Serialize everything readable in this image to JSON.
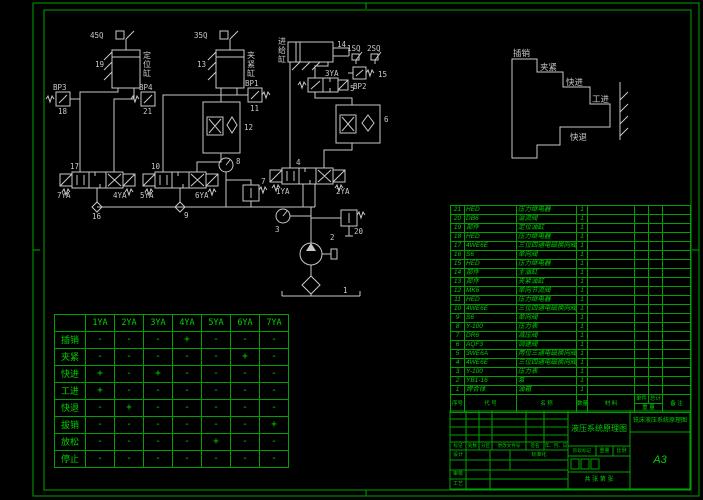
{
  "drawing": {
    "background": "#000000",
    "frame_color": "#00a400",
    "schematic_color": "#c8c8c8",
    "table_color": "#00d000"
  },
  "schematic": {
    "labels": [
      {
        "text": "45Q",
        "x": 90,
        "y": 38
      },
      {
        "text": "35Q",
        "x": 194,
        "y": 38
      },
      {
        "text": "19",
        "x": 95,
        "y": 67
      },
      {
        "text": "13",
        "x": 197,
        "y": 67
      },
      {
        "text": "定位缸",
        "x": 143,
        "y": 58,
        "vertical": true
      },
      {
        "text": "夹紧缸",
        "x": 247,
        "y": 58,
        "vertical": true
      },
      {
        "text": "进给缸",
        "x": 278,
        "y": 44,
        "vertical": true
      },
      {
        "text": "14",
        "x": 337,
        "y": 47
      },
      {
        "text": "BP3",
        "x": 53,
        "y": 90
      },
      {
        "text": "18",
        "x": 58,
        "y": 114
      },
      {
        "text": "BP4",
        "x": 139,
        "y": 90
      },
      {
        "text": "21",
        "x": 143,
        "y": 114
      },
      {
        "text": "BP1",
        "x": 245,
        "y": 86
      },
      {
        "text": "11",
        "x": 250,
        "y": 111
      },
      {
        "text": "12",
        "x": 244,
        "y": 130
      },
      {
        "text": "1SQ",
        "x": 347,
        "y": 51
      },
      {
        "text": "2SQ",
        "x": 367,
        "y": 51
      },
      {
        "text": "15",
        "x": 378,
        "y": 77
      },
      {
        "text": "BP2",
        "x": 353,
        "y": 89
      },
      {
        "text": "3YA",
        "x": 325,
        "y": 76
      },
      {
        "text": "5",
        "x": 350,
        "y": 91
      },
      {
        "text": "6",
        "x": 384,
        "y": 122
      },
      {
        "text": "17",
        "x": 70,
        "y": 169
      },
      {
        "text": "10",
        "x": 151,
        "y": 169
      },
      {
        "text": "4",
        "x": 296,
        "y": 165
      },
      {
        "text": "7YA",
        "x": 57,
        "y": 198
      },
      {
        "text": "4YA",
        "x": 113,
        "y": 198
      },
      {
        "text": "5YA",
        "x": 140,
        "y": 198
      },
      {
        "text": "6YA",
        "x": 195,
        "y": 198
      },
      {
        "text": "1YA",
        "x": 276,
        "y": 194
      },
      {
        "text": "2YA",
        "x": 336,
        "y": 194
      },
      {
        "text": "16",
        "x": 92,
        "y": 219
      },
      {
        "text": "9",
        "x": 184,
        "y": 218
      },
      {
        "text": "8",
        "x": 236,
        "y": 164
      },
      {
        "text": "7",
        "x": 261,
        "y": 184
      },
      {
        "text": "3",
        "x": 275,
        "y": 232
      },
      {
        "text": "2",
        "x": 330,
        "y": 240
      },
      {
        "text": "20",
        "x": 354,
        "y": 234
      },
      {
        "text": "1",
        "x": 343,
        "y": 293
      }
    ]
  },
  "cycle_diagram": {
    "steps": [
      "插销",
      "夹紧",
      "快进",
      "工进",
      "快退"
    ],
    "labels": [
      {
        "text": "插销",
        "x": 513,
        "y": 56
      },
      {
        "text": "夹紧",
        "x": 540,
        "y": 70
      },
      {
        "text": "快进",
        "x": 566,
        "y": 85
      },
      {
        "text": "工进",
        "x": 592,
        "y": 102
      },
      {
        "text": "快退",
        "x": 570,
        "y": 140
      }
    ]
  },
  "solenoid_table": {
    "columns": [
      "",
      "1YA",
      "2YA",
      "3YA",
      "4YA",
      "5YA",
      "6YA",
      "7YA"
    ],
    "rows": [
      {
        "name": "插销",
        "values": [
          "-",
          "-",
          "-",
          "+",
          "-",
          "-",
          "-"
        ]
      },
      {
        "name": "夹紧",
        "values": [
          "-",
          "-",
          "-",
          "-",
          "-",
          "+",
          "-"
        ]
      },
      {
        "name": "快进",
        "values": [
          "+",
          "-",
          "+",
          "-",
          "-",
          "-",
          "-"
        ]
      },
      {
        "name": "工进",
        "values": [
          "+",
          "-",
          "-",
          "-",
          "-",
          "-",
          "-"
        ]
      },
      {
        "name": "快退",
        "values": [
          "-",
          "+",
          "-",
          "-",
          "-",
          "-",
          "-"
        ]
      },
      {
        "name": "拔销",
        "values": [
          "-",
          "-",
          "-",
          "-",
          "-",
          "-",
          "+"
        ]
      },
      {
        "name": "放松",
        "values": [
          "-",
          "-",
          "-",
          "-",
          "+",
          "-",
          "-"
        ]
      },
      {
        "name": "停止",
        "values": [
          "-",
          "-",
          "-",
          "-",
          "-",
          "-",
          "-"
        ]
      }
    ]
  },
  "parts_list": {
    "footer": {
      "no": "序号",
      "code": "代 号",
      "name": "名  称",
      "qty": "数量",
      "material": "材 料",
      "unit": "单件",
      "total": "总计",
      "weight": "重 量",
      "remark": "备 注"
    },
    "rows": [
      {
        "no": "21",
        "code": "HED",
        "name": "压力继电器",
        "qty": "1"
      },
      {
        "no": "20",
        "code": "DB6",
        "name": "溢流阀",
        "qty": "1"
      },
      {
        "no": "19",
        "code": "部件",
        "name": "定位油缸",
        "qty": "1"
      },
      {
        "no": "18",
        "code": "HED",
        "name": "压力继电器",
        "qty": "1"
      },
      {
        "no": "17",
        "code": "4WE6E",
        "name": "三位四通电磁换向阀",
        "qty": "1"
      },
      {
        "no": "16",
        "code": "S6",
        "name": "单向阀",
        "qty": "1"
      },
      {
        "no": "15",
        "code": "HED",
        "name": "压力继电器",
        "qty": "1"
      },
      {
        "no": "14",
        "code": "部件",
        "name": "主油缸",
        "qty": "1"
      },
      {
        "no": "13",
        "code": "部件",
        "name": "夹紧油缸",
        "qty": "1"
      },
      {
        "no": "12",
        "code": "MK6",
        "name": "单向节流阀",
        "qty": "1"
      },
      {
        "no": "11",
        "code": "HED",
        "name": "压力继电器",
        "qty": "1"
      },
      {
        "no": "10",
        "code": "4WE6E",
        "name": "三位四通电磁换向阀",
        "qty": "1"
      },
      {
        "no": "9",
        "code": "S6",
        "name": "单向阀",
        "qty": "1"
      },
      {
        "no": "8",
        "code": "Y-100",
        "name": "压力表",
        "qty": "1"
      },
      {
        "no": "7",
        "code": "DR6",
        "name": "减压阀",
        "qty": "1"
      },
      {
        "no": "6",
        "code": "AQF3",
        "name": "调速阀",
        "qty": "1"
      },
      {
        "no": "5",
        "code": "3WE6A",
        "name": "两位三通电磁换向阀",
        "qty": "1"
      },
      {
        "no": "4",
        "code": "4WE6E",
        "name": "三位四通电磁换向阀",
        "qty": "1"
      },
      {
        "no": "3",
        "code": "Y-100",
        "name": "压力表",
        "qty": "1"
      },
      {
        "no": "2",
        "code": "YB1-16",
        "name": "泵",
        "qty": "1"
      },
      {
        "no": "1",
        "code": "焊合体",
        "name": "油箱",
        "qty": "1"
      }
    ]
  },
  "title_block": {
    "revision_columns": [
      "标记",
      "处数",
      "分区",
      "更改文件号",
      "签名",
      "年、月、日"
    ],
    "design_label": "设计",
    "standard_label": "标准化",
    "check_label": "审核",
    "process_label": "工艺",
    "stage_label": "阶段标记",
    "weight_label": "重量",
    "scale_label": "比例",
    "sheet_label": "共 张 第 张",
    "drawing_title": "液压系统原理图",
    "project_title": "铣床液压系统原理图",
    "sheet_size": "A3"
  }
}
